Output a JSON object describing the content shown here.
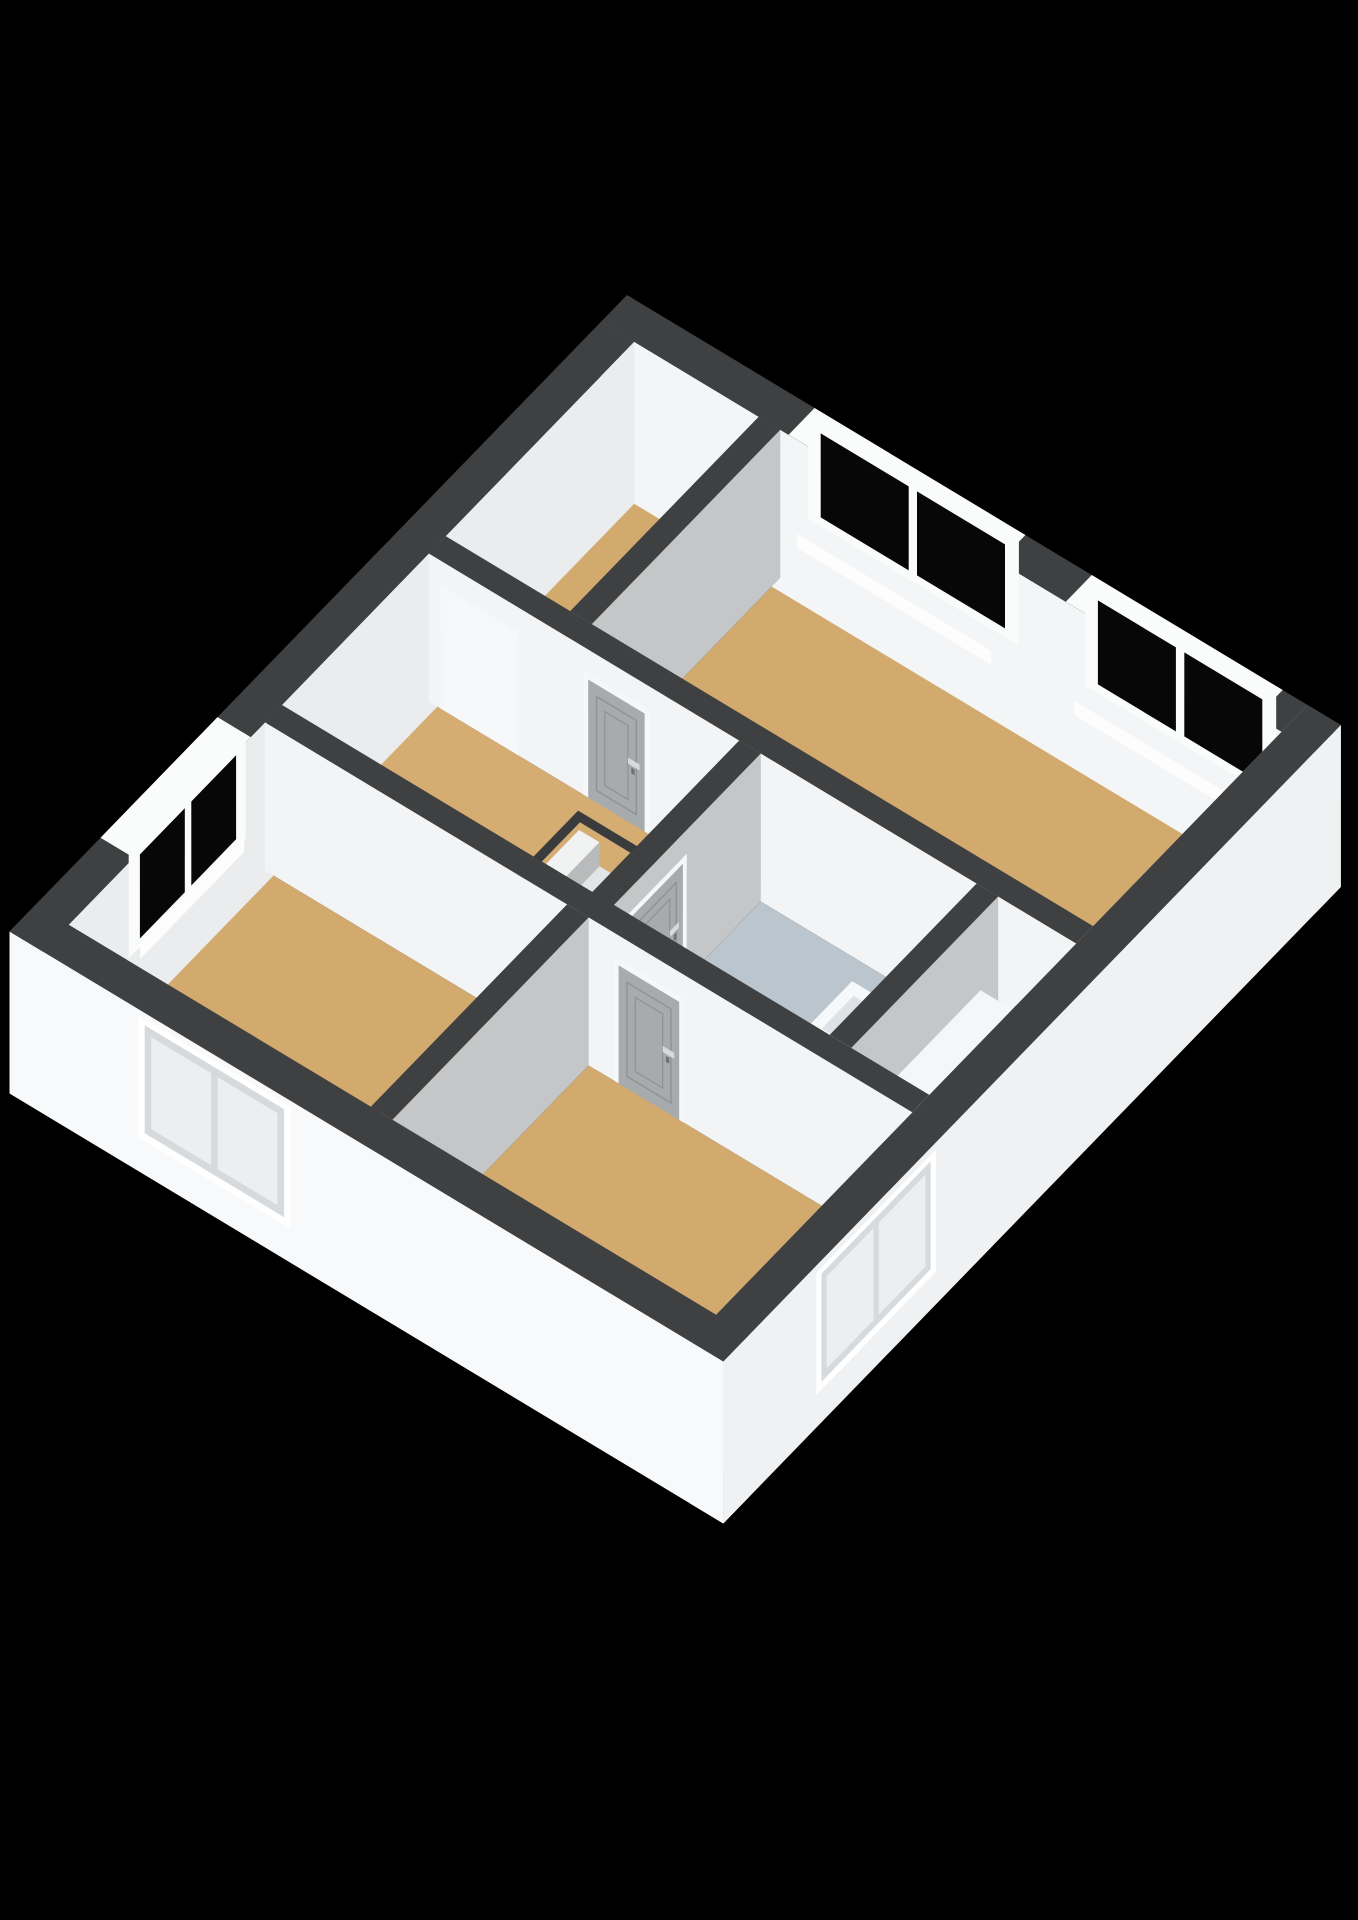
{
  "meta": {
    "description": "3D isometric floor plan render of an upper storey, no text labels visible",
    "background": "#000000"
  },
  "scene": {
    "projection": {
      "origin": [
        627,
        295
      ],
      "e1": [
        0.83,
        0.5
      ],
      "e2": [
        -0.65,
        0.67
      ],
      "wall_height": 148,
      "slab_drop": 14
    },
    "palette": {
      "wallTop": "#3f4042",
      "intS": "#f3f4f5",
      "intE": "#c4c6c8",
      "nwIn": "#eaecee",
      "neIn": "#f4f5f6",
      "seIn": "#caccce",
      "swOut": "#f8f9fa",
      "seOut": "#f0f1f2",
      "floorTan": "#d2aa6e",
      "floorTan2": "#d5ad73",
      "floorBath": "#bac5ce",
      "glass": "#070708",
      "frame": "#fafbfb",
      "door": "#a8abad",
      "doorEdge": "#8f9294",
      "jamb": "#f6f7f8",
      "handle": "#d8dadb",
      "hole": "#141516",
      "rim": "#3a3b3d",
      "sill": "#fdfdfd",
      "reveal": "#d7dadd",
      "pane": "#eceef0",
      "stringer": "#edeff0",
      "glassPanel": "rgba(198,212,222,0.5)"
    },
    "floors": [
      {
        "name": "floor-bedroom-top-left",
        "rect": [
          40,
          40,
          190,
          330
        ],
        "color": "floorTan"
      },
      {
        "name": "floor-bedroom-main",
        "rect": [
          216,
          40,
          820,
          330
        ],
        "color": "floorTan"
      },
      {
        "name": "floor-landing",
        "rect": [
          40,
          356,
          414,
          582
        ],
        "color": "floorTan2"
      },
      {
        "name": "floor-bathroom",
        "rect": [
          440,
          356,
          700,
          582
        ],
        "color": "floorBath"
      },
      {
        "name": "floor-closet-nook",
        "rect": [
          726,
          356,
          820,
          582
        ],
        "color": "floorTan"
      },
      {
        "name": "floor-bedroom-bottom-left",
        "rect": [
          40,
          608,
          404,
          910
        ],
        "color": "floorTan"
      },
      {
        "name": "floor-bedroom-bottom-right",
        "rect": [
          430,
          608,
          820,
          910
        ],
        "color": "floorTan"
      }
    ],
    "stairwell": {
      "name": "stairwell",
      "hole": [
        242,
        382,
        398,
        508
      ],
      "tread_span": [
        388,
        502
      ],
      "tread_colors": [
        "#f1f2f2",
        "#e3e4e5",
        "#d3d4d5",
        "#c2c3c4",
        "#b0b1b2",
        "#9e9fa0"
      ],
      "riser_shade": 0.88,
      "steps": 6
    },
    "solids": [
      {
        "type": "wall",
        "name": "wall-exterior-ne",
        "box": [
          0,
          0,
          860,
          40
        ],
        "faces": {
          "south": "neIn",
          "east": "seOut"
        },
        "zlo": -14,
        "decals": [
          {
            "type": "bandwin",
            "name": "window-ne-1",
            "axis": "u",
            "a1": 236,
            "a2": 470
          },
          {
            "type": "bandwin",
            "name": "window-ne-2",
            "axis": "u",
            "a1": 570,
            "a2": 780
          }
        ]
      },
      {
        "type": "wall",
        "name": "wall-exterior-nw",
        "box": [
          0,
          40,
          40,
          950
        ],
        "faces": {
          "east": "nwIn"
        },
        "zlo": -14,
        "decals": [
          {
            "type": "bandwin",
            "name": "window-nw-1",
            "axis": "v",
            "a1": 640,
            "a2": 800
          }
        ]
      },
      {
        "type": "wall",
        "name": "wall-divider-top",
        "box": [
          190,
          40,
          216,
          330
        ],
        "faces": {
          "south": "neIn",
          "east": "intE"
        }
      },
      {
        "type": "wall",
        "name": "wall-hall-north",
        "box": [
          40,
          330,
          820,
          356
        ],
        "faces": {
          "south": "intS",
          "east": "intE"
        },
        "decals": [
          {
            "type": "doorway",
            "name": "doorway-bedroom-top-left",
            "face": "v",
            "plane": 356,
            "a1": 54,
            "a2": 148
          },
          {
            "type": "door",
            "name": "door-bedroom-main",
            "face": "v",
            "plane": 356,
            "a1": 226,
            "a2": 306,
            "handle": "a2"
          }
        ]
      },
      {
        "type": "wall",
        "name": "wall-bathroom-west",
        "box": [
          414,
          356,
          440,
          608
        ],
        "faces": {
          "south": "intS",
          "east": "intE"
        },
        "decals": [
          {
            "type": "door",
            "name": "door-bathroom",
            "face": "u",
            "plane": 440,
            "a1": 470,
            "a2": 566,
            "handle": "a1"
          }
        ]
      },
      {
        "type": "box",
        "name": "fixture-vanity",
        "box": [
          608,
          430,
          698,
          560
        ],
        "h": 54,
        "faces": {
          "top": "#f7f8f9",
          "south": "#e9ebed",
          "east": "#dfe2e4"
        }
      },
      {
        "type": "top",
        "name": "fixture-basin-1",
        "rect": [
          620,
          443,
          688,
          492
        ],
        "z": 54,
        "color": "#dde2e6"
      },
      {
        "type": "top",
        "name": "fixture-basin-2",
        "rect": [
          620,
          500,
          688,
          549
        ],
        "z": 54,
        "color": "#dde2e6"
      },
      {
        "type": "top",
        "name": "fixture-faucet-1",
        "rect": [
          676,
          462,
          690,
          472
        ],
        "z": 55,
        "color": "#b7babc"
      },
      {
        "type": "top",
        "name": "fixture-faucet-2",
        "rect": [
          676,
          519,
          690,
          529
        ],
        "z": 55,
        "color": "#b7babc"
      },
      {
        "type": "box",
        "name": "fixture-toilet",
        "box": [
          540,
          497,
          584,
          551
        ],
        "h": 36,
        "faces": {
          "top": "#fbfcfd",
          "south": "#eceef0",
          "east": "#e2e4e6"
        }
      },
      {
        "type": "top",
        "name": "fixture-toilet-seat",
        "rect": [
          546,
          503,
          578,
          545
        ],
        "z": 36,
        "color": "#eef0f2"
      },
      {
        "type": "panel",
        "name": "fixture-shower-glass",
        "face": "v",
        "plane": 566,
        "a1": 608,
        "a2": 700,
        "z1": 0,
        "z2": 116,
        "color": "glassPanel",
        "rail": "#f0f2f3"
      },
      {
        "type": "wall",
        "name": "wall-bathroom-east",
        "box": [
          700,
          356,
          726,
          582
        ],
        "faces": {
          "south": "intS",
          "east": "intE"
        }
      },
      {
        "type": "box",
        "name": "fixture-closet",
        "box": [
          736,
          396,
          816,
          576
        ],
        "h": 86,
        "faces": {
          "top": "#f5f6f7",
          "south": "#eaecee",
          "east": "#dedfe2"
        }
      },
      {
        "type": "wall",
        "name": "wall-south-corridor",
        "box": [
          40,
          582,
          820,
          608
        ],
        "faces": {
          "south": "intS",
          "east": "intE"
        },
        "decals": [
          {
            "type": "door",
            "name": "door-bedroom-bottom-right",
            "face": "v",
            "plane": 608,
            "a1": 460,
            "a2": 545,
            "handle": "a2"
          }
        ]
      },
      {
        "type": "wall",
        "name": "wall-divider-bottom",
        "box": [
          404,
          608,
          430,
          910
        ],
        "faces": {
          "south": "intS",
          "east": "intE"
        }
      },
      {
        "type": "wall",
        "name": "wall-exterior-se",
        "box": [
          820,
          0,
          860,
          950
        ],
        "faces": {
          "west": "seIn",
          "south": "swOut",
          "east": "seOut"
        },
        "zlo": -14,
        "decals": [
          {
            "type": "extwin",
            "name": "window-se-1",
            "face": "u",
            "plane": 864,
            "a1": 640,
            "a2": 800,
            "z1": 24,
            "z2": 146
          }
        ]
      },
      {
        "type": "wall",
        "name": "wall-exterior-sw",
        "box": [
          0,
          910,
          860,
          950
        ],
        "faces": {
          "south": "swOut",
          "east": "seOut"
        },
        "zlo": -14,
        "decals": [
          {
            "type": "extwin",
            "name": "window-sw-1",
            "face": "v",
            "plane": 954,
            "a1": 170,
            "a2": 330,
            "z1": 24,
            "z2": 146
          }
        ]
      }
    ]
  }
}
